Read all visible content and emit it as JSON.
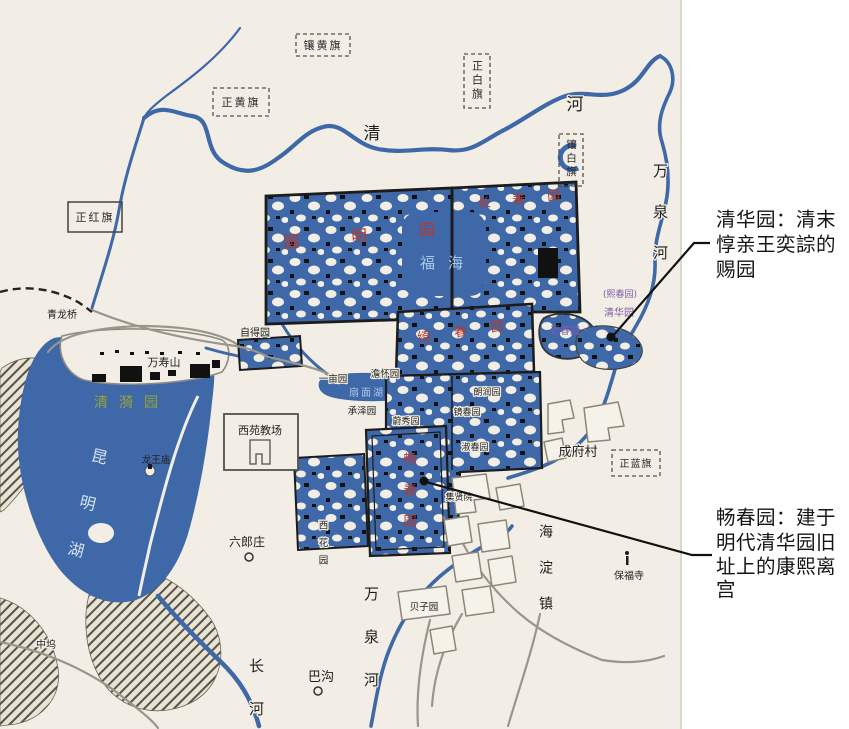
{
  "colors": {
    "paper": "#f2eee5",
    "water": "#3f68a8",
    "wall_black": "#1c1c1c",
    "road_gray": "#9a968c",
    "garden_red": "#b5392e",
    "qingyi_green": "#96a437",
    "qinghua_purple": "#7d5ca8",
    "water_label_blue": "#aac8e6",
    "note_black": "#141414"
  },
  "banners": {
    "xianghuangqi": "镶黄旗",
    "zhengbaiqi": "正白旗",
    "zhenghuangqi": "正黄旗",
    "xiangbaiqi": "镶白旗",
    "zhenghongqi": "正红旗",
    "zhenglanqi": "正蓝旗"
  },
  "rivers": {
    "qing": "清",
    "he": "河",
    "wanquan_right": "万泉河",
    "wanquan_bottom": "万泉河",
    "changhe": "长河"
  },
  "gardens": {
    "yuanmingyuan": "圆明园",
    "changchunyuan": "长春园",
    "qichunyuan": "绮春园",
    "fuhai": "福海",
    "qingyiyuan": "清漪园",
    "kunminghu": "昆明湖",
    "changchunyuan_kangxi": "畅春园",
    "jinchunyuan": "近春园",
    "xichunyuan": "(熙春园)",
    "qinghuayuan": "清华园",
    "shanmianhu": "扇面湖",
    "zideyuan": "自得园",
    "yimuyuan": "一亩园",
    "danhuaiyuan": "澹怀园",
    "chengzeyuan": "承泽园",
    "weixiuyuan": "蔚秀园",
    "jingchunyuan": "镜春园",
    "langrunyuan": "朗润园",
    "shuchunyuan": "淑春园",
    "jixianyuan": "集贤院",
    "xihuayuan": "西花园",
    "beiziyuan": "贝子园"
  },
  "places": {
    "qinglongqiao": "青龙桥",
    "wanshoushan": "万寿山",
    "longwangmiao": "龙王庙",
    "xiyuanjiaochang": "西苑教场",
    "liulangzhuang": "六郎庄",
    "zhongwu": "中坞",
    "bagou": "巴沟",
    "chengfucun": "成府村",
    "haidianzhen": "海淀镇",
    "baofusi": "保福寺"
  },
  "annotations": {
    "qinghua": {
      "l1": "清华园：清末",
      "l2": "惇亲王奕誴的",
      "l3": "赐园"
    },
    "changchun": {
      "l1": "畅春园：建于",
      "l2": "明代清华园旧",
      "l3": "址上的康熙离",
      "l4": "宫"
    }
  }
}
